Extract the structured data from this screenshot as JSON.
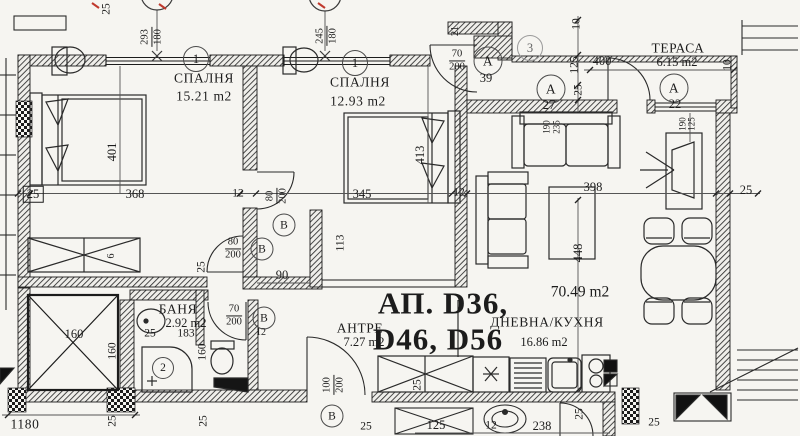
{
  "colors": {
    "paper": "#f6f5f1",
    "ink": "#1c1c1c",
    "dim_line": "#555555",
    "red_mark": "#c03a2e"
  },
  "rooms": {
    "bedroom1": {
      "number": "1",
      "name": "СПАЛНЯ",
      "area": "15.21 m2"
    },
    "bedroom2": {
      "number": "1",
      "name": "СПАЛНЯ",
      "area": "12.93 m2"
    },
    "living": {
      "number": "3",
      "name": "ДНЕВНА/КУХНЯ",
      "area": "16.86 m2"
    },
    "terrace": {
      "name": "ТЕРАСА",
      "area": "6.15 m2"
    },
    "bathroom": {
      "number": "2",
      "name": "БАНЯ",
      "area": "2.92 m2"
    },
    "hall": {
      "name": "АНТРЕ",
      "area": "7.27 m2"
    }
  },
  "apartment": {
    "label_line1": "АП. D36,",
    "label_line2": "D46, D56",
    "total_area": "70.49 m2"
  },
  "markers": {
    "a1": {
      "letter": "А",
      "number": "39"
    },
    "a2": {
      "letter": "А",
      "number": "27"
    },
    "a3": {
      "letter": "А",
      "number": "22"
    },
    "b": "В"
  },
  "openings": {
    "window1": {
      "w": "293",
      "h": "180"
    },
    "window2": {
      "w": "245",
      "h": "180"
    },
    "door70": {
      "w": "70",
      "h": "200"
    },
    "door80": {
      "w": "80",
      "h": "200"
    },
    "door100": {
      "w": "100",
      "h": "200"
    }
  },
  "dims": {
    "top_25": "25",
    "top_21": "21",
    "bed1_left": "25",
    "bed1_width": "368",
    "bed1_right": "12",
    "bed1_depth": "401",
    "wardrobe": "6",
    "bed2_width": "345",
    "bed2_right": "12",
    "bed2_depth": "413",
    "stub": "113",
    "corr_width": "90",
    "corr_25": "25",
    "right_10": "10",
    "right_125": "125",
    "right_25": "25",
    "right_400": "400",
    "terrace_10": "10",
    "tdoor_190": "190",
    "tdoor_125": "125",
    "sofa_190": "190",
    "sofa_235": "235",
    "living_width": "398",
    "living_right_25": "25",
    "living_depth": "448",
    "bath_25": "25",
    "bath_183": "183",
    "shaft_160": "160",
    "shaft_160b": "160",
    "wc_160": "160",
    "wc_12": "12",
    "kitchen_25": "25",
    "bottom_1180": "1180",
    "bottom_25a": "25",
    "bottom_25b": "25",
    "hall_25": "25",
    "low_125": "125",
    "low_12": "12",
    "low_238": "238",
    "low_25": "25",
    "low_25b": "25"
  }
}
